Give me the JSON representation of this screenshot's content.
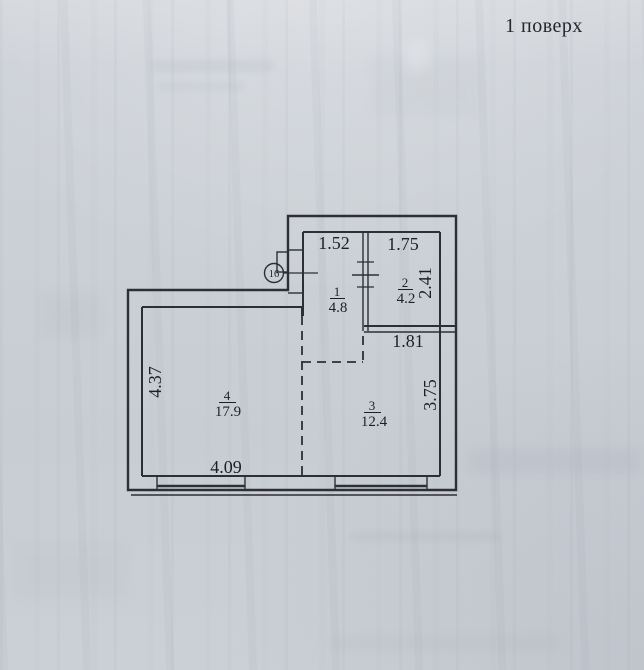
{
  "page": {
    "title": "1 поверх"
  },
  "plan": {
    "type": "floor-plan",
    "marker": {
      "label": "16"
    },
    "rooms": {
      "r1": {
        "num": "1",
        "area": "4.8"
      },
      "r2": {
        "num": "2",
        "area": "4.2"
      },
      "r3": {
        "num": "3",
        "area": "12.4"
      },
      "r4": {
        "num": "4",
        "area": "17.9"
      }
    },
    "dims": {
      "hall_top": "1.52",
      "bath_top": "1.75",
      "bath_right": "2.41",
      "below_bath": "1.81",
      "room3_right": "3.75",
      "room4_left": "4.37",
      "room4_bottom": "4.09"
    },
    "colors": {
      "paper": "#cbd0d6",
      "line": "#2e2e36",
      "text": "#1e1e26"
    }
  }
}
